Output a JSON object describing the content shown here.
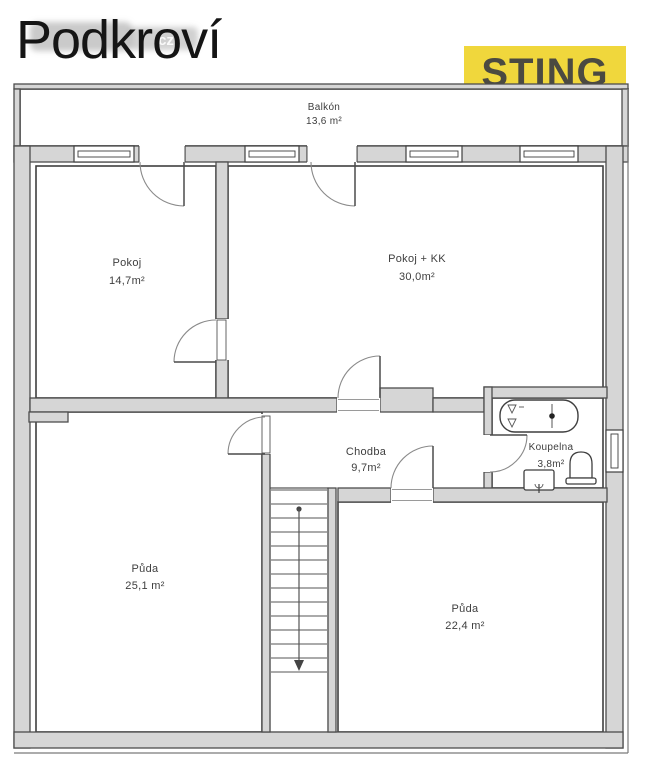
{
  "header": {
    "title": "Podkroví",
    "watermark": "cz",
    "brand": "STING"
  },
  "plan": {
    "balcony": {
      "name": "Balkón",
      "area": "13,6 m²"
    },
    "pokoj": {
      "name": "Pokoj",
      "area": "14,7m²"
    },
    "pokoj_kk": {
      "name": "Pokoj + KK",
      "area": "30,0m²"
    },
    "chodba": {
      "name": "Chodba",
      "area": "9,7m²"
    },
    "koupelna": {
      "name": "Koupelna",
      "area": "3,8m²"
    },
    "puda_left": {
      "name": "Půda",
      "area": "25,1 m²"
    },
    "puda_right": {
      "name": "Půda",
      "area": "22,4 m²"
    },
    "colors": {
      "wall_fill": "#d6d6d6",
      "wall_stroke": "#4d4d4d",
      "brand_yellow": "#f0d73c",
      "brand_text": "#4b4a41"
    }
  }
}
